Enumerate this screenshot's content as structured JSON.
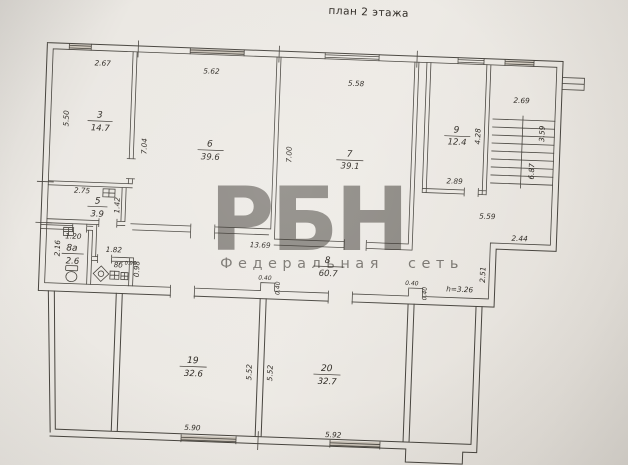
{
  "title": "план 2 этажа",
  "watermark": {
    "logo": "РБН",
    "subtitle": "Федеральная сеть",
    "logo_color": "#e4636d",
    "subtitle_color": "#b99d9b"
  },
  "colors": {
    "ink": "#47443e",
    "paper": "#e9e6e2"
  },
  "rooms": {
    "r3": {
      "num": "3",
      "area": "14.7"
    },
    "r5": {
      "num": "5",
      "area": "3.9"
    },
    "r6": {
      "num": "6",
      "area": "39.6"
    },
    "r7": {
      "num": "7",
      "area": "39.1"
    },
    "r8": {
      "num": "8",
      "area": "60.7"
    },
    "r8a": {
      "num": "8а",
      "area": "2.6"
    },
    "r8b": {
      "num": "8б"
    },
    "r9": {
      "num": "9",
      "area": "12.4"
    },
    "r19": {
      "num": "19",
      "area": "32.6"
    },
    "r20": {
      "num": "20",
      "area": "32.7"
    }
  },
  "dims": {
    "room3_w": "2.67",
    "room3_h": "5.50",
    "room6_w": "5.62",
    "room6_h": "7.04",
    "room7_w": "5.58",
    "room7_h": "7.00",
    "room9_w": "2.89",
    "room9_h": "4.28",
    "stair_w": "2.69",
    "stair_run1": "3.59",
    "stair_run2": "6.87",
    "hall_len": "5.59",
    "step_w": "2.44",
    "step_h": "2.51",
    "ceiling_h": "h=3.26",
    "room5_w": "2.75",
    "room5_h": "1.42",
    "room8a_w": "1.20",
    "room8a_h": "2.16",
    "room8b_w": "1.82",
    "room8b_h": "0.98",
    "room8b_small": "0.90",
    "corridor_len": "13.69",
    "notch1_w": "0.40",
    "notch1_h": "0.40",
    "notch2_w": "0.40",
    "notch2_h": "0.40",
    "room19_w": "5.90",
    "room19_h": "5.52",
    "room20_w": "5.92",
    "room20_h": "5.52"
  }
}
